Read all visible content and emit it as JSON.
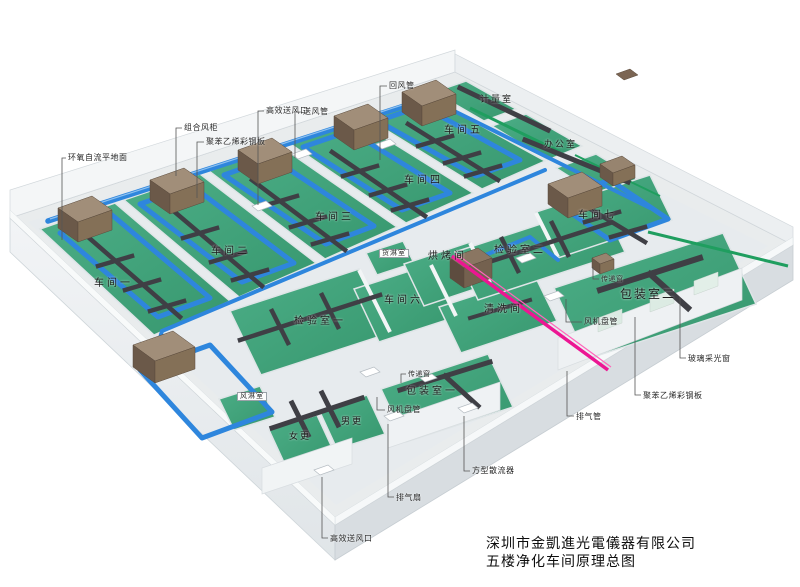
{
  "title_block": {
    "company": "深圳市金凱進光電儀器有限公司",
    "drawing_title": "五楼净化车间原理总图"
  },
  "rooms": {
    "workshop_1": "车间一",
    "workshop_2": "车间二",
    "workshop_3": "车间三",
    "workshop_4": "车间四",
    "workshop_5": "车间五",
    "workshop_6": "车间六",
    "workshop_7": "车间七",
    "inspection_1": "检验室一",
    "inspection_2": "检验室二",
    "packing_1": "包装室一",
    "packing_2": "包装室二",
    "cleaning_room": "清洗间",
    "baking_room": "烘烤间",
    "office": "办公室",
    "metering_room": "计量室",
    "cargo_shower": "货淋室",
    "air_shower": "风淋室",
    "men_changing": "男更",
    "women_changing": "女更"
  },
  "callouts": {
    "epoxy_floor": "环氧自流平地面",
    "combined_ahu": "组合风柜",
    "steel_panel_top": "聚苯乙烯彩钢板",
    "hepa_outlet_top": "高效送风口",
    "supply_duct": "送风管",
    "return_duct": "回风管",
    "fan_coil_right": "风机盘管",
    "transfer_window_right": "传递窗",
    "transfer_window_center": "传递窗",
    "fan_coil_center": "风机盘管",
    "square_diffuser": "方型散流器",
    "exhaust_fan": "排气扇",
    "hepa_outlet_bottom": "高效送风口",
    "exhaust_pipe": "排气管",
    "steel_panel_right": "聚苯乙烯彩钢板",
    "glass_window": "玻璃采光窗"
  },
  "colors": {
    "floor_green": "#40a27a",
    "duct_blue": "#2e86dd",
    "duct_dark": "#3f3f45",
    "ahu_brown_top": "#a18e79",
    "ahu_brown_front": "#6b5949",
    "exhaust_pink": "#ec1693",
    "wall_light": "#eef0f2",
    "slab_shadow": "#d8dde1",
    "stripe_green": "#1f9e5f",
    "label_text": "#1c1c1c"
  }
}
